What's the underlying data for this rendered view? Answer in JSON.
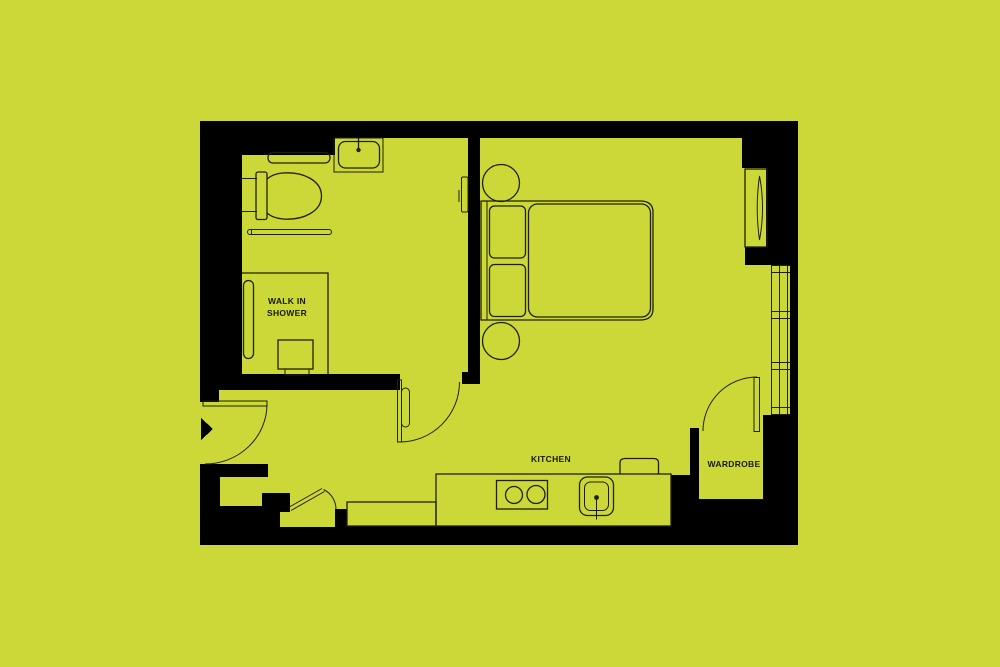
{
  "page": {
    "title": "Studio apartment floor plan"
  },
  "colors": {
    "background": "#cbd838",
    "walls": "#000000",
    "fixture_lines": "#20200a",
    "label_text": "#191905"
  },
  "labels": {
    "walk_in_shower_line1": "WALK IN",
    "walk_in_shower_line2": "SHOWER",
    "kitchen": "KITCHEN",
    "wardrobe": "WARDROBE"
  },
  "fixtures": [
    "entry-door",
    "entry-arrow",
    "hall-door",
    "wardrobe-door",
    "storage-hatch-door",
    "toilet",
    "bathroom-shelf",
    "towel-rail",
    "bathroom-sink",
    "sink-tap",
    "shower-screen",
    "shower-tray-box",
    "double-bed",
    "pillow",
    "mattress",
    "bedside-table",
    "mirror-unit",
    "window",
    "kitchen-counter",
    "kitchen-low-counter",
    "hob",
    "kitchen-sink",
    "kitchen-appliance",
    "wall-panel"
  ]
}
